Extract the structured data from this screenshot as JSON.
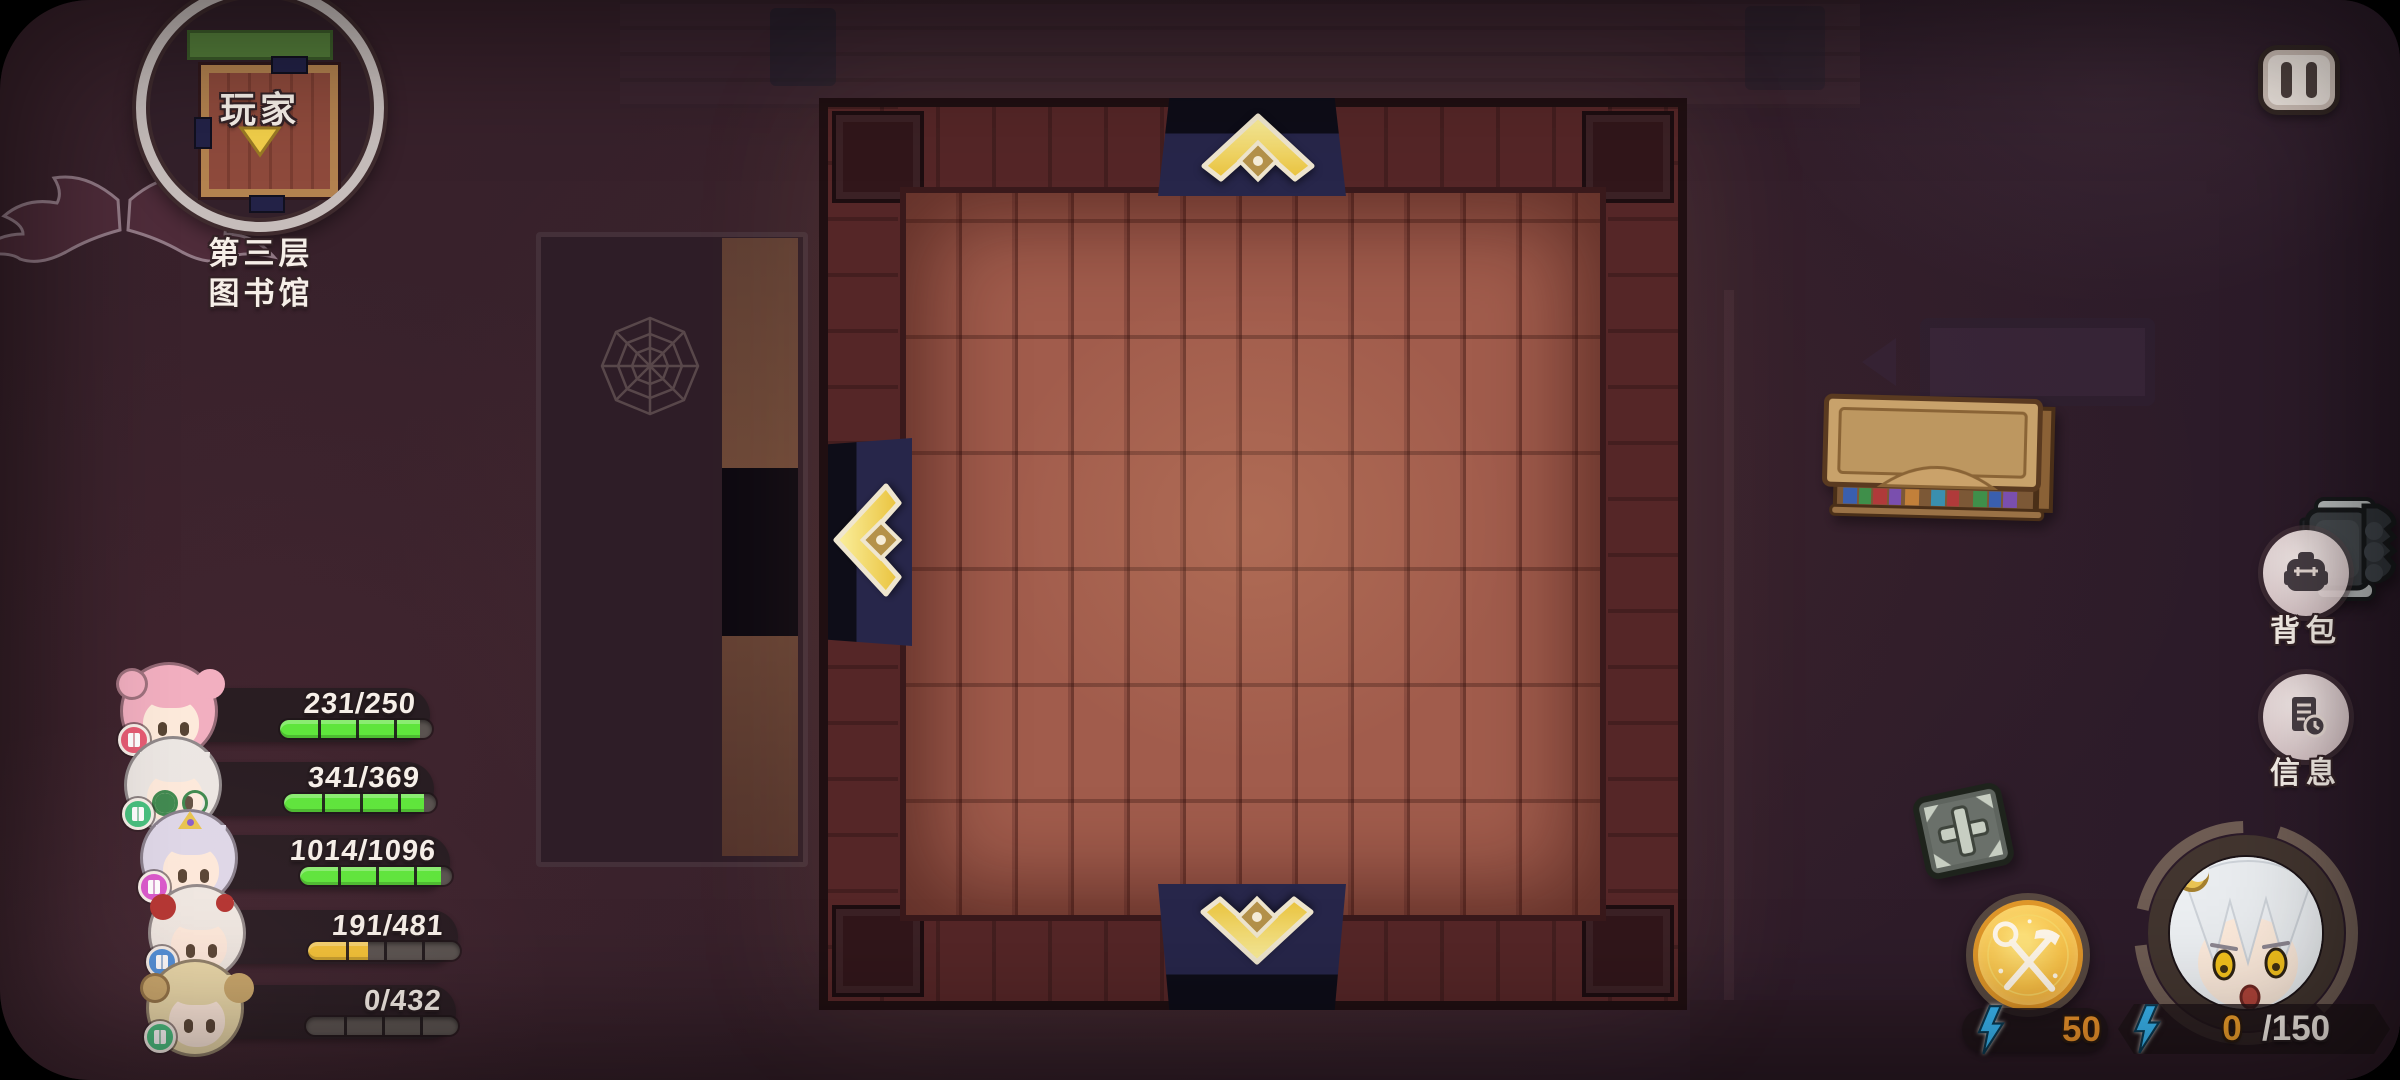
{
  "minimap": {
    "player_label": "玩家",
    "floor_label": "第三层",
    "location_label": "图书馆"
  },
  "right_menu": {
    "inventory_label": "背包",
    "info_label": "信息"
  },
  "mine_button": {
    "cost": "50"
  },
  "energy": {
    "current": "0",
    "max": "/150"
  },
  "party": {
    "members": [
      {
        "hp": "231/250",
        "pct": 92.4,
        "bar_color": "#5fe53c",
        "hair": "#f2afc0",
        "accessory": "buns",
        "badge": "#e75c74"
      },
      {
        "hp": "341/369",
        "pct": 92.4,
        "bar_color": "#5fe53c",
        "hair": "#ece7e3",
        "accessory": "glasses",
        "badge": "#46c07e"
      },
      {
        "hp": "1014/1096",
        "pct": 92.5,
        "bar_color": "#5fe53c",
        "hair": "#ded8e8",
        "accessory": "tiara",
        "badge": "#da58cc"
      },
      {
        "hp": "191/481",
        "pct": 39.7,
        "bar_color": "#f2c136",
        "hair": "#efe9e2",
        "accessory": "flower",
        "badge": "#4e8fd8"
      },
      {
        "hp": "0/432",
        "pct": 0,
        "bar_color": "#f2c136",
        "hair": "#e9d9a8",
        "accessory": "horns",
        "badge": "#46c07e"
      }
    ]
  },
  "room": {
    "exits": [
      "up",
      "left",
      "down"
    ],
    "objects": [
      "bookshelf",
      "armchair",
      "supply-crate"
    ]
  },
  "icons": {
    "pause": "two-vertical-bars",
    "inventory": "backpack",
    "info": "document-with-clock",
    "mine": "crossed-pickaxe-and-scepter",
    "energy": "lightning-bolt",
    "player_direction": "down-triangle",
    "exit_arrow": "gold-chevron",
    "decor": [
      "spider-web",
      "bat-wings"
    ]
  },
  "palette": {
    "hp_green": "#5fe53c",
    "hp_yellow": "#f2c136",
    "energy_orange": "#f0962c",
    "lightning_blue": "#3ab8f4",
    "arrow_gold": "#f3d95e",
    "doorway_navy": "#27264a",
    "minimap_ring": "#c6bdbb"
  }
}
